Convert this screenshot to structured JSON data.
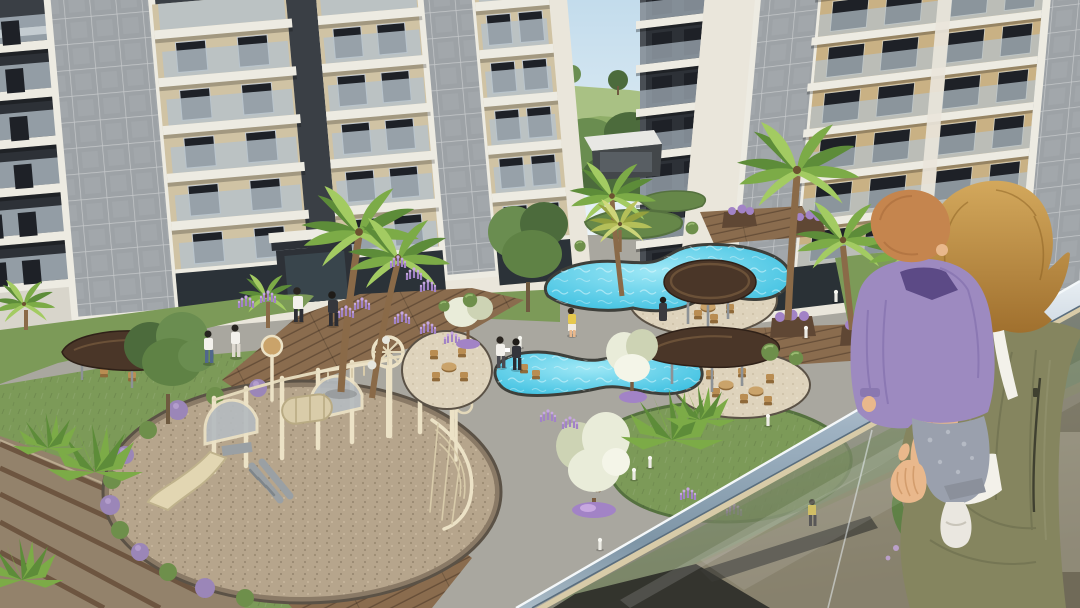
{
  "scene": {
    "type": "3d-architectural-rendering",
    "setting": "Residential complex courtyard with pools and playground viewed from an apartment balcony",
    "time_of_day": "daylight",
    "camera": "elevated balcony view looking down into landscaped courtyard"
  },
  "palette": {
    "sky1": "#c3dcec",
    "sky2": "#eaf3f8",
    "hill": "#a9c184",
    "lawn": "#8fae68",
    "treedark": "#4c6b3c",
    "tree": "#6a8d50",
    "cream": "#eae6db",
    "creamShade": "#d9d4c6",
    "perf": "#9da2a6",
    "perfline": "#c5c8ca",
    "dark1": "#3a3f45",
    "dark2": "#2d3137",
    "win": "#1e2127",
    "glassbal": "#b5c2cb",
    "slab": "#edebe2",
    "stone": "#d0c3a4",
    "woodwall": "#c9b184",
    "path": "#a9a79f",
    "pathlight": "#c0beb6",
    "grass": "#7c9a58",
    "grassdark": "#668749",
    "bush": "#6e8f4b",
    "deck": "#8a6c4e",
    "deckdark": "#664e38",
    "gravel": "#b6a58c",
    "graveldark": "#93826b",
    "edge": "#5b5246",
    "water1": "#9fe8f6",
    "water2": "#2cb9dd",
    "apron": "#ded3bc",
    "canopy": "#4a3628",
    "canopyrim": "#6b5138",
    "leg": "#8d9296",
    "wicker": "#b98d52",
    "wickerdark": "#8f6a3a",
    "trunk": "#8a6a48",
    "frond": "#7cab47",
    "fronddark": "#5d8c39",
    "frondlight": "#a3cb62",
    "planter": "#5f4734",
    "lav": "#a283c6",
    "lavlight": "#c7a8e0",
    "bloom": "#e9ecd9",
    "bloomshade": "#cdd3b4",
    "metal1": "#e8eef3",
    "metal2": "#9fb2c2",
    "metal3": "#7e95a6",
    "ledge": "#d8cba8",
    "glasstint": "#a8b09e",
    "glassdark2": "#70705e",
    "skin": "#e9b88c",
    "skinshade": "#c9915f",
    "hair1": "#d3a85c",
    "hair2": "#a0702e",
    "olive": "#85855f",
    "olivedark": "#686a4a",
    "whitecloth": "#f3f1ea",
    "babyhair": "#c5854e",
    "purple": "#9d8ac0",
    "purpledark": "#6a589c",
    "collar": "#5c4a86",
    "pants": "#9aa0ad",
    "sock": "#eae7e0"
  },
  "objects": {
    "buildings": [
      {
        "id": "left-block",
        "facade": "cream frame, beige stone bays, glass balconies, two gray perforated metal panels, dark upper floors"
      },
      {
        "id": "center-tower",
        "facade": "dark gray with white balcony slabs"
      },
      {
        "id": "right-block",
        "facade": "wood-tone window bays, white floor bands, gray perforated panels"
      }
    ],
    "amenities": [
      "organic-shaped swimming pool upper",
      "organic-shaped swimming pool lower",
      "round brown shade canopy",
      "leaf-shaped brown shade canopy",
      "left wing canopy with seating",
      "wicker chairs and tables",
      "children playground with slide, arch tunnels and climbing wheels",
      "clubhouse in background",
      "wooden deck paths",
      "terraced timber steps",
      "bollard lights",
      "sphere lamps"
    ],
    "vegetation": [
      "tall palm trees in wooden planters",
      "fan palms",
      "green leafy trees",
      "white blossom trees with purple flower rings",
      "lavender flower clusters",
      "boxwood hedge balls",
      "lawn patches and mounds"
    ],
    "people": [
      {
        "where": "wooden deck",
        "desc": "two women walking, white tops"
      },
      {
        "where": "near entrance",
        "desc": "man in white shirt and man in dark suit"
      },
      {
        "where": "pool side",
        "desc": "two men talking, one holding papers"
      },
      {
        "where": "upper pool deck",
        "desc": "person in yellow top"
      },
      {
        "where": "behind balcony glass",
        "desc": "small figure in yellow shirt"
      }
    ],
    "foreground": {
      "woman": "blonde short-haired woman seen from behind, olive-green sleeveless jumpsuit over white tank top",
      "baby": "baby with strawberry-blond hair, purple sweatshirt, gray pants, one white sock",
      "railing": "glass balustrade with brushed metal handrail running diagonally"
    }
  }
}
